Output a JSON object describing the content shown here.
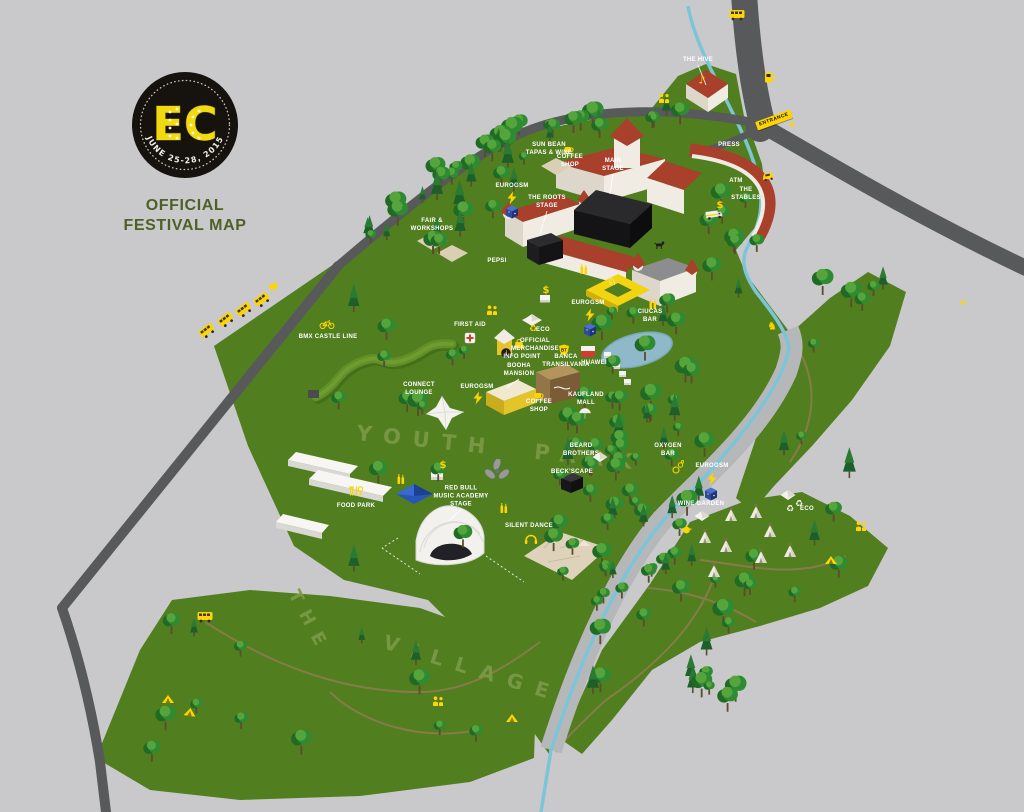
{
  "page": {
    "title": "EC Official Festival Map"
  },
  "logo": {
    "initials": "EC",
    "dates": "JUNE 25-28, 2015",
    "subtitle_line1": "OFFICIAL",
    "subtitle_line2": "FESTIVAL MAP"
  },
  "areas": {
    "park_text": "YOUTH PARK",
    "village_line1": "THE",
    "village_line2": "VILLAGE"
  },
  "colors": {
    "accent_yellow": "#ffd400",
    "grass": "#517e1f",
    "road": "#58595b",
    "river": "#7cc5d8",
    "label_text": "#ffffff",
    "logo_green": "#4e6026"
  },
  "map": {
    "entrance_sign": {
      "text": "ENTRANCE"
    },
    "labels": [
      {
        "id": "the-hive",
        "lines": [
          "THE HIVE"
        ],
        "x": 698,
        "y": 61,
        "leader": [
          706,
          85
        ]
      },
      {
        "id": "press",
        "lines": [
          "PRESS"
        ],
        "x": 729,
        "y": 146
      },
      {
        "id": "atm",
        "lines": [
          "ATM"
        ],
        "x": 736,
        "y": 182
      },
      {
        "id": "the-stables",
        "lines": [
          "THE",
          "STABLES"
        ],
        "x": 746,
        "y": 195
      },
      {
        "id": "tapas-wine",
        "lines": [
          "SUN BEAN",
          "TAPAS & WINE"
        ],
        "x": 549,
        "y": 150
      },
      {
        "id": "coffee-shop-castle",
        "lines": [
          "COFFEE",
          "SHOP"
        ],
        "x": 570,
        "y": 162
      },
      {
        "id": "main-stage",
        "lines": [
          "MAIN",
          "STAGE"
        ],
        "x": 613,
        "y": 166,
        "leader": [
          610,
          194
        ]
      },
      {
        "id": "roots-stage",
        "lines": [
          "THE ROOTS",
          "STAGE"
        ],
        "x": 547,
        "y": 203,
        "leader": [
          540,
          234
        ]
      },
      {
        "id": "eurogsm-castle",
        "lines": [
          "EUROGSM"
        ],
        "x": 512,
        "y": 187
      },
      {
        "id": "pepsi",
        "lines": [
          "PEPSI"
        ],
        "x": 497,
        "y": 262
      },
      {
        "id": "fair-workshops",
        "lines": [
          "FAIR &",
          "WORKSHOPS"
        ],
        "x": 432,
        "y": 226
      },
      {
        "id": "first-aid",
        "lines": [
          "FIRST AID"
        ],
        "x": 470,
        "y": 326
      },
      {
        "id": "eco-central",
        "lines": [
          "ECO"
        ],
        "x": 543,
        "y": 331
      },
      {
        "id": "official-merchandise",
        "lines": [
          "OFFICIAL",
          "MERCHANDISE"
        ],
        "x": 535,
        "y": 346
      },
      {
        "id": "info-point",
        "lines": [
          "INFO POINT"
        ],
        "x": 522,
        "y": 358
      },
      {
        "id": "banca-transilvania",
        "lines": [
          "BANCA",
          "TRANSILVANIA"
        ],
        "x": 566,
        "y": 362
      },
      {
        "id": "huawei",
        "lines": [
          "HUAWEI"
        ],
        "x": 594,
        "y": 364
      },
      {
        "id": "eurogsm-lake",
        "lines": [
          "EUROGSM"
        ],
        "x": 588,
        "y": 304
      },
      {
        "id": "ciucas-bar",
        "lines": [
          "CIUCAS",
          "BAR"
        ],
        "x": 650,
        "y": 317
      },
      {
        "id": "kaufland-mall",
        "lines": [
          "KAUFLAND",
          "MALL"
        ],
        "x": 586,
        "y": 400
      },
      {
        "id": "booha-mansion",
        "lines": [
          "BOOHA",
          "MANSION"
        ],
        "x": 519,
        "y": 371,
        "leader": [
          507,
          387
        ]
      },
      {
        "id": "coffee-shop-park",
        "lines": [
          "COFFEE",
          "SHOP"
        ],
        "x": 539,
        "y": 407
      },
      {
        "id": "eurogsm-park",
        "lines": [
          "EUROGSM"
        ],
        "x": 477,
        "y": 388
      },
      {
        "id": "connect-lounge",
        "lines": [
          "CONNECT",
          "LOUNGE"
        ],
        "x": 419,
        "y": 390
      },
      {
        "id": "bmx-castle-line",
        "lines": [
          "BMX CASTLE LINE"
        ],
        "x": 328,
        "y": 338
      },
      {
        "id": "food-park",
        "lines": [
          "FOOD PARK"
        ],
        "x": 356,
        "y": 507
      },
      {
        "id": "red-bull-music-academy-stage",
        "lines": [
          "RED BULL",
          "MUSIC ACADEMY",
          "STAGE"
        ],
        "x": 461,
        "y": 497,
        "leader": [
          449,
          521
        ]
      },
      {
        "id": "silent-dance",
        "lines": [
          "SILENT DANCE"
        ],
        "x": 529,
        "y": 527
      },
      {
        "id": "beard-brothers",
        "lines": [
          "BEARD",
          "BROTHERS"
        ],
        "x": 581,
        "y": 451
      },
      {
        "id": "becks-cape",
        "lines": [
          "BECK'SCAPE"
        ],
        "x": 572,
        "y": 473
      },
      {
        "id": "oxygen-bar",
        "lines": [
          "OXYGEN",
          "BAR"
        ],
        "x": 668,
        "y": 451
      },
      {
        "id": "eurogsm-river",
        "lines": [
          "EUROGSM"
        ],
        "x": 712,
        "y": 467
      },
      {
        "id": "wine-garden",
        "lines": [
          "WINE GARDEN"
        ],
        "x": 701,
        "y": 505
      },
      {
        "id": "eco-village",
        "lines": [
          "ECO"
        ],
        "x": 807,
        "y": 510
      }
    ],
    "icons": [
      {
        "t": "bus",
        "x": 207,
        "y": 331,
        "r": -38
      },
      {
        "t": "bus",
        "x": 226,
        "y": 320,
        "r": -38
      },
      {
        "t": "bus",
        "x": 244,
        "y": 310,
        "r": -38
      },
      {
        "t": "bus",
        "x": 262,
        "y": 300,
        "r": -38
      },
      {
        "t": "sign",
        "x": 274,
        "y": 288,
        "r": -20
      },
      {
        "t": "bus",
        "x": 737,
        "y": 15,
        "r": 0
      },
      {
        "t": "fuel",
        "x": 770,
        "y": 77,
        "r": 0
      },
      {
        "t": "chevrons",
        "x": 792,
        "y": 124,
        "r": -15
      },
      {
        "t": "chevrons",
        "x": 963,
        "y": 302,
        "r": -25
      },
      {
        "t": "car",
        "x": 768,
        "y": 176,
        "r": -12
      },
      {
        "t": "music-note",
        "x": 702,
        "y": 80,
        "r": 0
      },
      {
        "t": "people",
        "x": 664,
        "y": 98,
        "r": 0
      },
      {
        "t": "people",
        "x": 492,
        "y": 310,
        "r": 0
      },
      {
        "t": "people",
        "x": 861,
        "y": 526,
        "r": 0
      },
      {
        "t": "people",
        "x": 438,
        "y": 701,
        "r": 0
      },
      {
        "t": "dollar",
        "x": 720,
        "y": 206,
        "r": 0
      },
      {
        "t": "dollar",
        "x": 443,
        "y": 466,
        "r": 0
      },
      {
        "t": "dollar",
        "x": 546,
        "y": 291,
        "r": 0
      },
      {
        "t": "bolt",
        "x": 512,
        "y": 198,
        "r": 0
      },
      {
        "t": "bolt",
        "x": 590,
        "y": 315,
        "r": 0
      },
      {
        "t": "bolt",
        "x": 478,
        "y": 398,
        "r": 0
      },
      {
        "t": "bolt",
        "x": 712,
        "y": 479,
        "r": 0
      },
      {
        "t": "cube",
        "x": 512,
        "y": 212,
        "r": 0
      },
      {
        "t": "cube",
        "x": 590,
        "y": 330,
        "r": 0
      },
      {
        "t": "cube",
        "x": 711,
        "y": 494,
        "r": 0
      },
      {
        "t": "first-aid",
        "x": 470,
        "y": 338,
        "r": 0
      },
      {
        "t": "info",
        "x": 506,
        "y": 353,
        "r": 0
      },
      {
        "t": "merch",
        "x": 519,
        "y": 344,
        "r": 0
      },
      {
        "t": "bt",
        "x": 564,
        "y": 350,
        "r": 0
      },
      {
        "t": "recycle",
        "x": 533,
        "y": 330,
        "r": 0,
        "c": "#ffd400"
      },
      {
        "t": "recycle",
        "x": 790,
        "y": 510,
        "r": 0,
        "c": "#f4f2ea"
      },
      {
        "t": "recycle",
        "x": 799,
        "y": 505,
        "r": 0,
        "c": "#f4f2ea"
      },
      {
        "t": "cup",
        "x": 569,
        "y": 150,
        "r": 0
      },
      {
        "t": "cup",
        "x": 539,
        "y": 396,
        "r": 0
      },
      {
        "t": "bottles",
        "x": 584,
        "y": 269,
        "r": 0
      },
      {
        "t": "bottles",
        "x": 653,
        "y": 304,
        "r": 0
      },
      {
        "t": "bottles",
        "x": 401,
        "y": 479,
        "r": 0
      },
      {
        "t": "bottles",
        "x": 504,
        "y": 508,
        "r": 0
      },
      {
        "t": "headphones",
        "x": 531,
        "y": 539,
        "r": 0
      },
      {
        "t": "bike",
        "x": 327,
        "y": 324,
        "r": 0
      },
      {
        "t": "horse",
        "x": 772,
        "y": 326,
        "r": 0
      },
      {
        "t": "teapot",
        "x": 686,
        "y": 529,
        "r": 0
      },
      {
        "t": "umbrella",
        "x": 585,
        "y": 413,
        "r": 0
      },
      {
        "t": "cutlery",
        "x": 356,
        "y": 491,
        "r": 0
      },
      {
        "t": "bubbles",
        "x": 678,
        "y": 467,
        "r": 0
      },
      {
        "t": "propeller",
        "x": 497,
        "y": 470,
        "r": 0
      },
      {
        "t": "dog",
        "x": 660,
        "y": 245,
        "r": 0
      },
      {
        "t": "unicorn",
        "x": 612,
        "y": 283,
        "r": 0
      },
      {
        "t": "tent",
        "x": 168,
        "y": 699,
        "r": 0
      },
      {
        "t": "tent",
        "x": 190,
        "y": 712,
        "r": 8
      },
      {
        "t": "tent",
        "x": 512,
        "y": 718,
        "r": 0
      },
      {
        "t": "tent",
        "x": 831,
        "y": 560,
        "r": 0
      },
      {
        "t": "tipi",
        "x": 731,
        "y": 514,
        "r": 0
      },
      {
        "t": "tipi",
        "x": 756,
        "y": 511,
        "r": 0
      },
      {
        "t": "tipi",
        "x": 770,
        "y": 530,
        "r": 0
      },
      {
        "t": "tipi",
        "x": 705,
        "y": 536,
        "r": 0
      },
      {
        "t": "tipi",
        "x": 726,
        "y": 545,
        "r": 0
      },
      {
        "t": "tipi",
        "x": 761,
        "y": 556,
        "r": 0
      },
      {
        "t": "tipi",
        "x": 790,
        "y": 550,
        "r": 0
      },
      {
        "t": "tipi",
        "x": 714,
        "y": 570,
        "r": 0
      },
      {
        "t": "white-tent",
        "x": 788,
        "y": 495,
        "r": 0
      },
      {
        "t": "white-tent",
        "x": 702,
        "y": 516,
        "r": 0
      },
      {
        "t": "white-tent",
        "x": 600,
        "y": 457,
        "r": 0
      },
      {
        "t": "white-tent",
        "x": 532,
        "y": 319,
        "r": 0
      },
      {
        "t": "truck",
        "x": 714,
        "y": 215,
        "r": -8
      },
      {
        "t": "bus",
        "x": 205,
        "y": 617,
        "r": 0
      }
    ]
  }
}
